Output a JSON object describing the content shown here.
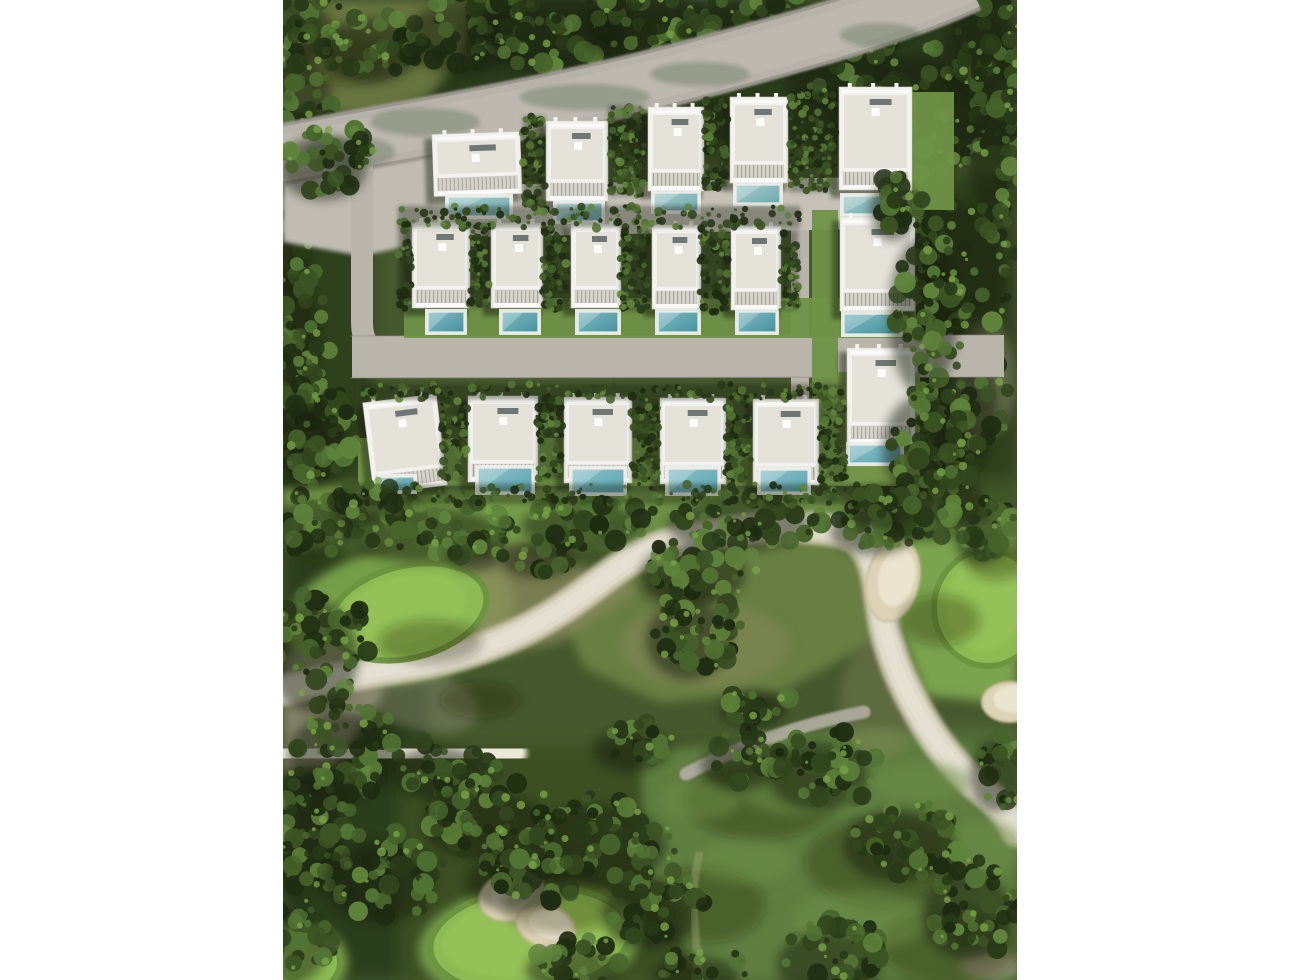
{
  "canvas": {
    "w": 1290,
    "h": 980,
    "photo_x": 283,
    "photo_w": 734,
    "photo_h": 980,
    "bg": "#ffffff"
  },
  "palette": {
    "ground": "#46592e",
    "foliage": [
      "#1e2c12",
      "#283a18",
      "#32461e",
      "#3c5424",
      "#47642b",
      "#527434",
      "#60843c"
    ],
    "foliage_hi": "#79a347",
    "fairway": "#6c8f46",
    "fairway_light": "#7ba34f",
    "fairway_dim": "#5f7e41",
    "fairway_mid": "#6a8143",
    "green": "#8fbb54",
    "green_in": "#9cc65d",
    "green_ring": "#6d9440",
    "green_fringe": "#7aa24c",
    "scrub": "#8b8a5e",
    "scrub_gray": "#99947d",
    "top_lawn": "#67743f",
    "creek": "#ece8dc",
    "creek_edge": "#d6cfba",
    "creek_core": "#f4f1e8",
    "creek_speck": "#c9c2ab",
    "sand": "#ddd3b6",
    "sand_hi": "#ece5d0",
    "sand_ring": "#c9bd9e",
    "road": "#b7b3aa",
    "road_dark": "#9c988f",
    "road_light": "#c1bdb4",
    "gravel": "#b9b5ab",
    "apron": "#c0bcb2",
    "court": "#c5c1b7",
    "curb": "#8d8a81",
    "path_gray": "#b3aea4",
    "tan_path": "#9aa06f",
    "lawn": "#6f9247",
    "lawn3": "#76994b",
    "villa": "#f3f2ee",
    "roof": "#e5e2da",
    "villa_edge": "#cfccc4",
    "parapet": "#fafaf8",
    "louver": "#d7d4cc",
    "louver_line": "#a3a39c",
    "skylight": "#6f7774",
    "deck": "#edeee9",
    "pool_edge": "#eef0ea",
    "shadow": "#141f0b",
    "mottle": "#6e9048"
  },
  "pool_styles": [
    [
      "#a5cbcb",
      "#6fa9ae"
    ],
    [
      "#7fbac2",
      "#46929f"
    ],
    [
      "#8fc0c8",
      "#58a5b2"
    ]
  ],
  "ground_zones": [
    [
      283,
      0,
      734,
      150,
      "#2a3a1a"
    ],
    [
      283,
      130,
      90,
      400,
      "#2f401e"
    ],
    [
      916,
      175,
      101,
      380,
      "#2f401e"
    ],
    [
      283,
      545,
      145,
      435,
      "#2b3c1b"
    ],
    [
      400,
      745,
      330,
      235,
      "#3a4f24"
    ],
    [
      735,
      730,
      282,
      250,
      "#546f3a"
    ],
    [
      283,
      480,
      734,
      75,
      "#3f5526"
    ]
  ],
  "fairways": [
    {
      "type": "poly",
      "pts": "283,0 470,0 462,55 430,95 378,118 283,108",
      "fill": "top_lawn",
      "op": 1
    },
    {
      "type": "rect",
      "x": 283,
      "y": 487,
      "w": 540,
      "h": 60,
      "fill": "fairway_light",
      "op": 0.9
    },
    {
      "type": "rect",
      "x": 640,
      "y": 495,
      "w": 300,
      "h": 55,
      "fill": "fairway",
      "op": 0.9
    },
    {
      "type": "ellipse",
      "cx": 400,
      "cy": 616,
      "rx": 115,
      "ry": 68,
      "rot": -10,
      "fill": "green_fringe",
      "op": 0.95
    },
    {
      "type": "poly",
      "pts": "885,528 1017,515 1017,705 925,695 893,610",
      "fill": "fairway_light",
      "op": 1
    },
    {
      "type": "poly",
      "pts": "560,615 650,552 780,532 862,545 876,640 780,692 660,702 585,668",
      "fill": "fairway_mid",
      "op": 0.95
    },
    {
      "type": "poly",
      "pts": "640,752 880,728 1017,758 1017,980 700,980 645,862",
      "fill": "fairway_dim",
      "op": 1
    },
    {
      "type": "ellipse",
      "cx": 530,
      "cy": 942,
      "rx": 112,
      "ry": 58,
      "rot": -6,
      "fill": "green_fringe",
      "op": 0.9
    },
    {
      "type": "ellipse",
      "cx": 296,
      "cy": 962,
      "rx": 52,
      "ry": 40,
      "rot": 0,
      "fill": "green_fringe",
      "op": 0.9
    }
  ],
  "scrub": [
    {
      "type": "poly",
      "pts": "395,568 520,546 640,588 560,642 468,662 408,622",
      "fill": "scrub",
      "op": 0.75
    },
    {
      "type": "poly",
      "pts": "283,655 345,638 385,692 335,765 283,772",
      "fill": "scrub_gray",
      "op": 0.8
    },
    {
      "type": "ellipse",
      "cx": 705,
      "cy": 645,
      "rx": 85,
      "ry": 42,
      "rot": 0,
      "fill": "scrub",
      "op": 0.45
    },
    {
      "type": "ellipse",
      "cx": 880,
      "cy": 700,
      "rx": 40,
      "ry": 60,
      "rot": 0,
      "fill": "scrub",
      "op": 0.35
    },
    {
      "type": "ellipse",
      "cx": 990,
      "cy": 965,
      "rx": 30,
      "ry": 14,
      "rot": 0,
      "fill": "scrub_gray",
      "op": 0.8
    },
    {
      "type": "ellipse",
      "cx": 420,
      "cy": 700,
      "rx": 60,
      "ry": 30,
      "rot": 15,
      "fill": "scrub_gray",
      "op": 0.4
    },
    {
      "type": "ellipse",
      "cx": 985,
      "cy": 380,
      "rx": 30,
      "ry": 60,
      "rot": 0,
      "fill": "scrub_gray",
      "op": 0.45
    }
  ],
  "creek": {
    "main": "M283,690 C340,676 372,672 420,664 C472,655 520,636 560,610 C600,584 622,560 656,548 C700,533 760,524 810,528 C842,530 858,534 868,552 C880,574 878,602 886,634 C894,666 906,690 922,718 C938,746 958,770 982,790 C1002,806 1012,820 1017,832",
    "branch": "M283,756 C335,752 430,748 516,753",
    "spur": "M866,550 C870,532 877,517 890,503",
    "w_main": 22,
    "w_edge": 32,
    "w_branch": 16,
    "w_spur": 9
  },
  "greens": [
    [
      408,
      612,
      80,
      46,
      -14
    ],
    [
      988,
      608,
      54,
      58,
      0
    ],
    [
      530,
      940,
      100,
      52,
      -6
    ],
    [
      296,
      962,
      44,
      33,
      0
    ]
  ],
  "bunkers": [
    [
      893,
      580,
      26,
      42,
      12
    ],
    [
      1010,
      702,
      28,
      20,
      0
    ],
    [
      512,
      896,
      33,
      24,
      -15
    ],
    [
      546,
      926,
      30,
      21,
      18
    ]
  ],
  "cart_path": "M686,774 C728,752 790,726 864,712",
  "tan_path": "M700,982 C696,934 688,894 700,852",
  "roads": {
    "main_d": "M278,155 C420,128 560,106 700,68 C800,41 900,14 968,-18",
    "apron": "283,150 433,126 470,198 436,240 362,256 283,242",
    "h_d": "M352,357 L1004,356",
    "v_left": "M362,162 L362,322 Q362,357 398,357",
    "v_right": "M800,203 L800,472",
    "curb_top": "M350,336 L1000,335",
    "curb_bot": "M350,378 L1000,377"
  },
  "road_shadows": [
    [
      425,
      122,
      55,
      14
    ],
    [
      585,
      97,
      65,
      13
    ],
    [
      350,
      152,
      45,
      16
    ],
    [
      700,
      74,
      50,
      12
    ],
    [
      880,
      35,
      40,
      12
    ]
  ],
  "courts": [
    {
      "type": "poly",
      "pts": "433,186 912,176 912,228 433,238",
      "fill": "court",
      "op": 1
    }
  ],
  "lawns": [
    [
      404,
      298,
      512,
      40,
      "lawn"
    ],
    [
      812,
      210,
      26,
      262,
      "lawn"
    ],
    [
      358,
      438,
      562,
      48,
      "lawn3"
    ],
    [
      836,
      372,
      84,
      96,
      "lawn3"
    ],
    [
      912,
      92,
      42,
      118,
      "lawn"
    ]
  ],
  "fairway_shadows": [
    [
      760,
      800,
      75,
      40
    ],
    [
      885,
      862,
      80,
      45
    ],
    [
      705,
      905,
      60,
      38
    ],
    [
      950,
      945,
      70,
      38
    ],
    [
      680,
      588,
      40,
      18
    ],
    [
      430,
      642,
      52,
      22
    ],
    [
      560,
      905,
      58,
      28
    ],
    [
      480,
      700,
      40,
      18
    ],
    [
      340,
      60,
      60,
      25
    ],
    [
      940,
      620,
      40,
      25
    ],
    [
      996,
      560,
      30,
      20
    ]
  ],
  "mottle": [
    [
      800,
      790,
      60,
      25
    ],
    [
      920,
      782,
      50,
      20
    ],
    [
      860,
      920,
      70,
      30
    ],
    [
      745,
      862,
      50,
      22
    ],
    [
      985,
      848,
      38,
      28
    ],
    [
      700,
      800,
      40,
      20
    ]
  ],
  "trees": [
    [
      300,
      25,
      45,
      38,
      40,
      11
    ],
    [
      380,
      42,
      52,
      36,
      38,
      12
    ],
    [
      470,
      30,
      60,
      40,
      42,
      13
    ],
    [
      560,
      25,
      80,
      45,
      55,
      14
    ],
    [
      660,
      22,
      70,
      40,
      48,
      15
    ],
    [
      760,
      30,
      75,
      42,
      50,
      16
    ],
    [
      850,
      60,
      60,
      48,
      48,
      17
    ],
    [
      930,
      110,
      60,
      70,
      60,
      18
    ],
    [
      990,
      45,
      38,
      55,
      38,
      19
    ],
    [
      1000,
      150,
      25,
      60,
      32,
      20
    ],
    [
      300,
      88,
      42,
      38,
      32,
      21
    ],
    [
      330,
      152,
      55,
      42,
      45,
      22
    ],
    [
      294,
      235,
      28,
      58,
      38,
      23
    ],
    [
      300,
      335,
      30,
      75,
      48,
      24
    ],
    [
      302,
      432,
      34,
      55,
      38,
      25
    ],
    [
      920,
      162,
      28,
      45,
      28,
      26
    ],
    [
      958,
      268,
      60,
      85,
      70,
      27
    ],
    [
      952,
      402,
      56,
      85,
      68,
      28
    ],
    [
      938,
      492,
      55,
      45,
      42,
      29
    ],
    [
      990,
      530,
      28,
      30,
      22,
      30
    ],
    [
      320,
      522,
      45,
      33,
      32,
      31
    ],
    [
      432,
      527,
      85,
      30,
      50,
      32
    ],
    [
      592,
      518,
      65,
      25,
      36,
      33
    ],
    [
      748,
      518,
      75,
      28,
      44,
      34
    ],
    [
      882,
      524,
      45,
      25,
      26,
      35
    ],
    [
      547,
      552,
      38,
      20,
      20,
      36
    ],
    [
      482,
      549,
      28,
      16,
      14,
      37
    ],
    [
      702,
      566,
      55,
      35,
      36,
      38
    ],
    [
      697,
      632,
      44,
      44,
      42,
      39
    ],
    [
      322,
      648,
      48,
      62,
      50,
      40
    ],
    [
      352,
      748,
      58,
      48,
      44,
      41
    ],
    [
      310,
      828,
      44,
      70,
      50,
      42
    ],
    [
      388,
      874,
      58,
      45,
      42,
      43
    ],
    [
      300,
      938,
      38,
      42,
      30,
      44
    ],
    [
      448,
      766,
      50,
      30,
      32,
      45
    ],
    [
      492,
      817,
      65,
      38,
      44,
      46
    ],
    [
      607,
      838,
      72,
      45,
      48,
      47
    ],
    [
      527,
      874,
      55,
      32,
      34,
      48
    ],
    [
      657,
      907,
      48,
      38,
      36,
      49
    ],
    [
      582,
      962,
      50,
      25,
      24,
      50
    ],
    [
      705,
      968,
      45,
      22,
      20,
      51
    ],
    [
      748,
      757,
      40,
      28,
      25,
      52
    ],
    [
      827,
      768,
      52,
      38,
      38,
      53
    ],
    [
      907,
      838,
      58,
      40,
      42,
      54
    ],
    [
      977,
      908,
      48,
      48,
      42,
      55
    ],
    [
      838,
      957,
      55,
      38,
      36,
      56
    ],
    [
      1004,
      768,
      26,
      40,
      26,
      57
    ],
    [
      762,
      702,
      35,
      22,
      20,
      58
    ],
    [
      640,
      742,
      40,
      24,
      24,
      59
    ]
  ],
  "trees_front": [
    [
      332,
      160,
      46,
      36,
      38,
      71
    ],
    [
      322,
      434,
      36,
      50,
      38,
      72
    ],
    [
      932,
      308,
      36,
      88,
      55,
      73
    ],
    [
      930,
      440,
      40,
      58,
      42,
      74
    ],
    [
      902,
      202,
      24,
      34,
      22,
      75
    ],
    [
      368,
      500,
      30,
      20,
      18,
      76
    ],
    [
      890,
      500,
      35,
      22,
      20,
      77
    ]
  ],
  "hedges": [
    [
      523,
      116,
      22,
      88,
      81
    ],
    [
      608,
      106,
      36,
      90,
      82
    ],
    [
      703,
      99,
      24,
      90,
      83
    ],
    [
      789,
      92,
      47,
      100,
      84
    ],
    [
      398,
      206,
      402,
      22,
      85
    ],
    [
      469,
      224,
      21,
      84,
      86
    ],
    [
      542,
      226,
      26,
      84,
      87
    ],
    [
      620,
      227,
      29,
      84,
      88
    ],
    [
      700,
      228,
      28,
      84,
      89
    ],
    [
      780,
      230,
      18,
      80,
      90
    ],
    [
      398,
      224,
      13,
      85,
      91
    ],
    [
      362,
      384,
      480,
      16,
      92
    ],
    [
      441,
      400,
      26,
      80,
      93
    ],
    [
      537,
      398,
      26,
      82,
      94
    ],
    [
      631,
      399,
      28,
      82,
      95
    ],
    [
      725,
      400,
      27,
      82,
      96
    ],
    [
      818,
      402,
      28,
      78,
      97
    ],
    [
      358,
      484,
      562,
      20,
      98
    ],
    [
      916,
      218,
      14,
      95,
      99
    ]
  ],
  "villas": {
    "rows": [
      {
        "name": "top-row",
        "units": [
          [
            433,
            133,
            88,
            62,
            -2,
            448,
            197,
            62,
            19,
            0
          ],
          [
            546,
            121,
            62,
            80,
            0,
            556,
            203,
            46,
            18,
            0
          ],
          [
            648,
            107,
            56,
            84,
            0,
            654,
            193,
            44,
            18,
            0
          ],
          [
            730,
            97,
            58,
            86,
            0,
            736,
            185,
            44,
            18,
            0
          ],
          [
            839,
            87,
            73,
            103,
            0,
            843,
            196,
            54,
            18,
            0
          ]
        ]
      },
      {
        "name": "middle-row",
        "units": [
          [
            412,
            222,
            58,
            86,
            0,
            428,
            312,
            36,
            20,
            1
          ],
          [
            491,
            223,
            52,
            85,
            0,
            502,
            312,
            36,
            20,
            1
          ],
          [
            571,
            224,
            50,
            84,
            0,
            578,
            312,
            40,
            20,
            1
          ],
          [
            652,
            225,
            49,
            84,
            0,
            658,
            312,
            40,
            20,
            1
          ],
          [
            731,
            226,
            50,
            84,
            0,
            738,
            312,
            38,
            20,
            1
          ],
          [
            840,
            217,
            75,
            94,
            0,
            844,
            314,
            56,
            20,
            1
          ]
        ]
      },
      {
        "name": "bottom-row",
        "units": [
          [
            368,
            398,
            74,
            92,
            -7,
            380,
            477,
            34,
            14,
            2
          ],
          [
            468,
            396,
            70,
            86,
            0,
            478,
            468,
            54,
            24,
            2
          ],
          [
            564,
            397,
            68,
            86,
            0,
            572,
            469,
            52,
            24,
            2
          ],
          [
            660,
            398,
            66,
            86,
            0,
            668,
            469,
            50,
            24,
            2
          ],
          [
            753,
            399,
            66,
            86,
            0,
            760,
            470,
            48,
            22,
            2
          ],
          [
            847,
            348,
            68,
            96,
            0,
            849,
            445,
            52,
            18,
            2
          ]
        ]
      }
    ]
  }
}
